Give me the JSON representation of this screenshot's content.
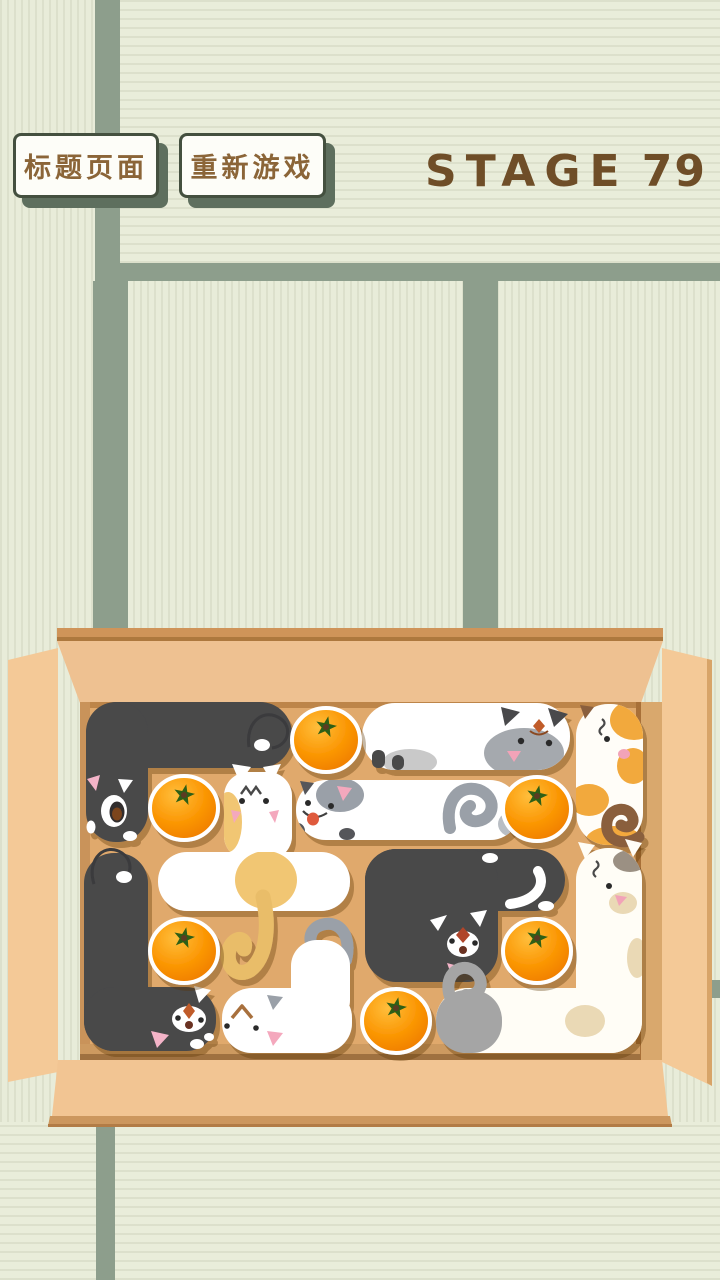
{
  "screen": {
    "type": "cat-box-puzzle-game",
    "width": 720,
    "height": 1280
  },
  "header": {
    "buttons": [
      {
        "id": "title-page",
        "label": "标题页面"
      },
      {
        "id": "restart-game",
        "label": "重新游戏"
      }
    ],
    "stage": {
      "label": "STAGE",
      "value": "79"
    }
  },
  "colors": {
    "tatami": "#e8ecd9",
    "tatami_band": "#8d9e8c",
    "button_text": "#8b6538",
    "button_shadow": "#5e6f5e",
    "stage_text": "#6f4e28",
    "box_floor": "#e0a96c",
    "box_wall": "#eec191",
    "box_flap": "#f4c997",
    "box_rim": "#cc975e",
    "cat_dark": "#48484a",
    "cat_white": "#ffffff",
    "cat_yellow": "#f1c673",
    "cat_orange_patch": "#f2a93e",
    "cat_gray_patch": "#9aa0a8",
    "cat_cream_patch": "#ead9b5",
    "orange_fruit": "#fb9704",
    "orange_leaf": "#2e5e17"
  },
  "board": {
    "grid": {
      "cols": 6,
      "rows": 4
    },
    "container": "open cardboard box on tatami floor",
    "oranges": [
      {
        "cx": 326,
        "cy": 740
      },
      {
        "cx": 184,
        "cy": 808
      },
      {
        "cx": 537,
        "cy": 809
      },
      {
        "cx": 184,
        "cy": 951
      },
      {
        "cx": 537,
        "cy": 951
      },
      {
        "cx": 396,
        "cy": 1021
      }
    ],
    "cats": [
      {
        "id": "black-cat-top-left",
        "color": "dark-gray",
        "shape": "L",
        "area": "top-left",
        "head": "bottom of vertical part, facing down",
        "features": "pink ear, white open-mouth muzzle, white-tipped curled tail"
      },
      {
        "id": "siamese-cat",
        "color": "white",
        "shape": "horizontal",
        "area": "top-middle",
        "head": "right end",
        "features": "gray face patch, dark ears and paws, red forehead mark, pink nose"
      },
      {
        "id": "calico-cat-vertical",
        "color": "white",
        "shape": "vertical",
        "area": "top-right",
        "head": "top",
        "features": "orange patches, brown curled tail, worried squiggle"
      },
      {
        "id": "yellow-belly-cat",
        "color": "white",
        "shape": "T",
        "area": "middle-left",
        "head": "upright at top",
        "features": "yellow belly, yellow curled tail, zigzag brow, pink cheeks"
      },
      {
        "id": "gray-patch-cat",
        "color": "white",
        "shape": "horizontal",
        "area": "middle",
        "head": "left end",
        "features": "gray head patch, tongue out, gray curled tail, dark paw"
      },
      {
        "id": "black-cat-s",
        "color": "dark-gray",
        "shape": "S",
        "area": "middle-right",
        "head": "facing right",
        "features": "white blaze, red diamond mark, white tail tip, pink paw"
      },
      {
        "id": "black-cat-bottom-left",
        "color": "dark-gray",
        "shape": "L",
        "area": "bottom-left",
        "head": "corner facing right",
        "features": "white muzzle with orange diamond, white-tipped curled tail, pink paw"
      },
      {
        "id": "white-cat-bottom",
        "color": "white",
        "shape": "L",
        "area": "bottom-middle",
        "head": "left end",
        "features": "brown chevron brow, gray curled tail, gray ear"
      },
      {
        "id": "cream-cat-right",
        "color": "cream-white",
        "shape": "L",
        "area": "bottom-right",
        "head": "top of vertical part",
        "features": "beige patches, gray crown patch, gray rump with curled tail, worried squiggle"
      }
    ]
  }
}
